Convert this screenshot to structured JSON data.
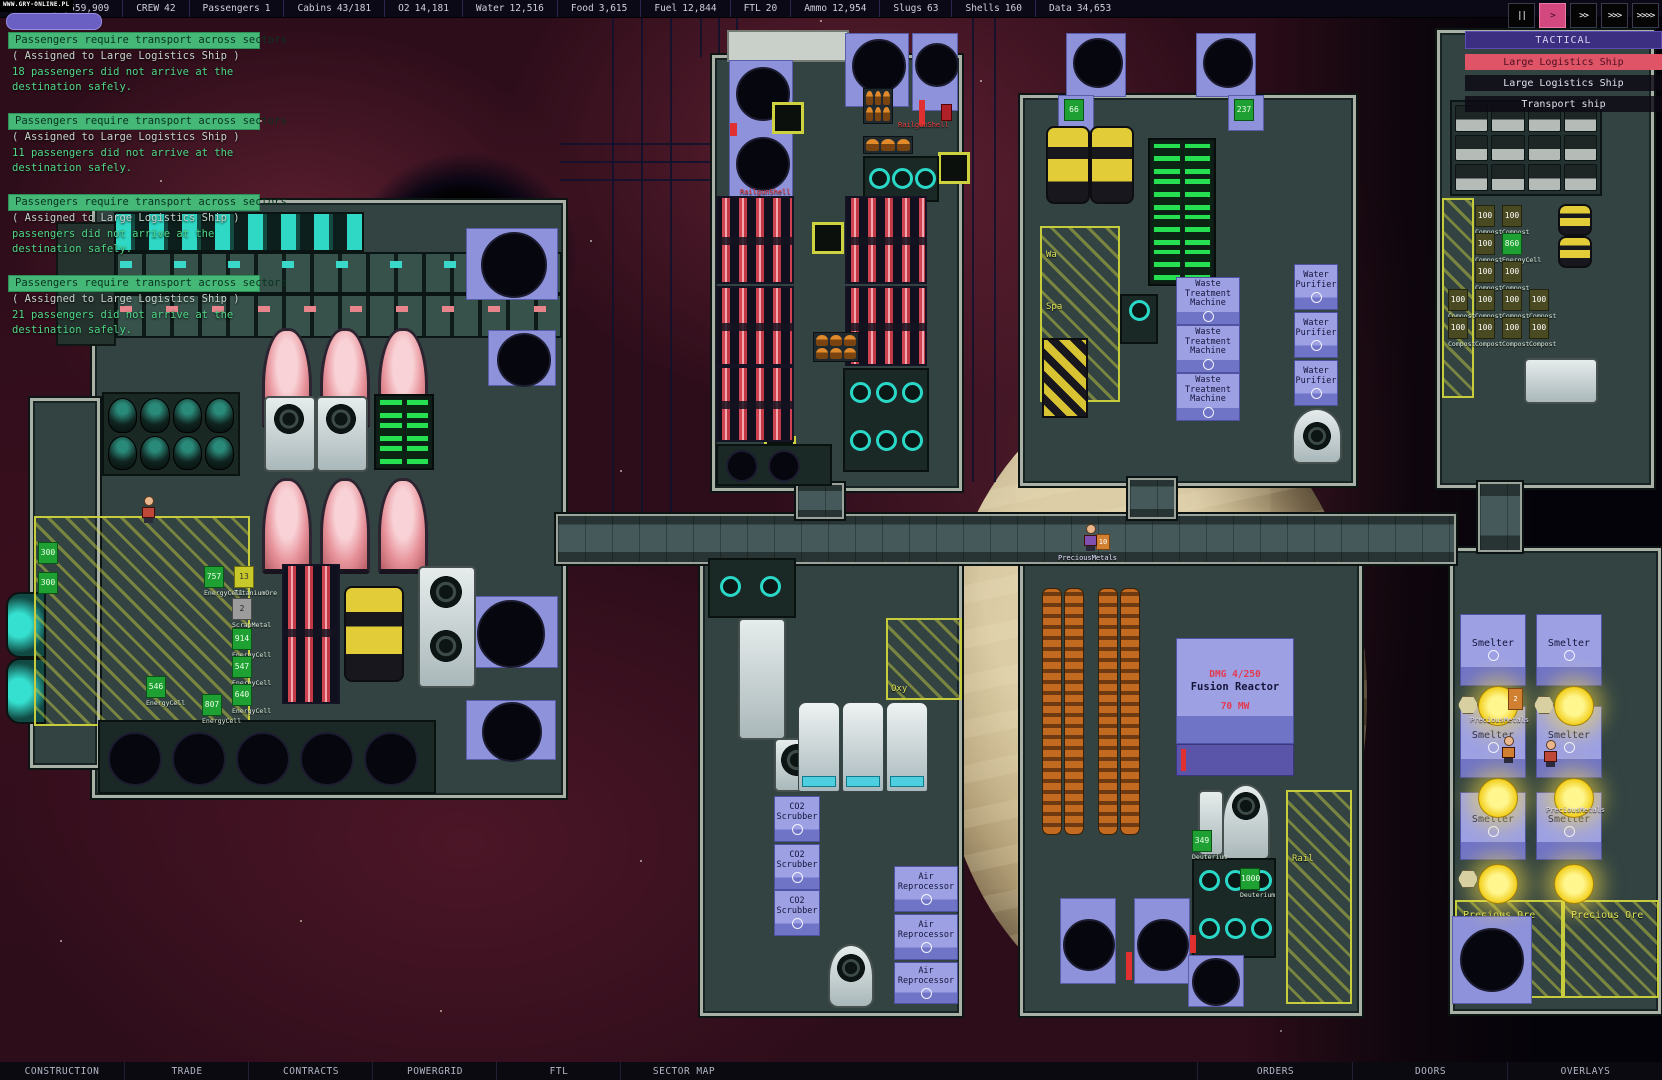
{
  "watermark": "WWW.GRY-ONLINE.PL",
  "topbar": {
    "money": "$8,559,909",
    "stats": [
      {
        "label": "CREW",
        "value": "42"
      },
      {
        "label": "Passengers",
        "value": "1"
      },
      {
        "label": "Cabins",
        "value": "43/181"
      },
      {
        "label": "O2",
        "value": "14,181"
      },
      {
        "label": "Water",
        "value": "12,516"
      },
      {
        "label": "Food",
        "value": "3,615"
      },
      {
        "label": "Fuel",
        "value": "12,844"
      },
      {
        "label": "FTL",
        "value": "20"
      },
      {
        "label": "Ammo",
        "value": "12,954"
      },
      {
        "label": "Slugs",
        "value": "63"
      },
      {
        "label": "Shells",
        "value": "160"
      },
      {
        "label": "Data",
        "value": "34,653"
      }
    ]
  },
  "speed_controls": {
    "pause": "||",
    "play": ">",
    "ff2": ">>",
    "ff3": ">>>",
    "ff4": ">>>>"
  },
  "notifications": [
    {
      "title": "Passengers require transport across sectors",
      "assigned": "( Assigned to Large Logistics Ship )",
      "line1": "18 passengers did not arrive at the",
      "line2": "destination safely."
    },
    {
      "title": "Passengers require transport across sectors",
      "assigned": "( Assigned to Large Logistics Ship )",
      "line1": "11 passengers did not arrive at the",
      "line2": "destination safely."
    },
    {
      "title": "Passengers require transport across sectors",
      "assigned": "( Assigned to Large Logistics Ship )",
      "line1": "passengers did not arrive at the",
      "line2": "destination safely."
    },
    {
      "title": "Passengers require transport across sectors",
      "assigned": "( Assigned to Large Logistics Ship )",
      "line1": "21 passengers did not arrive at the",
      "line2": "destination safely."
    }
  ],
  "tactical": {
    "title": "TACTICAL",
    "ships": [
      {
        "name": "Large Logistics Ship",
        "selected": true
      },
      {
        "name": "Large Logistics Ship",
        "selected": false
      },
      {
        "name": "Transport ship",
        "selected": false
      }
    ]
  },
  "bottombar": {
    "left": [
      "CONSTRUCTION",
      "TRADE",
      "CONTRACTS",
      "POWERGRID",
      "FTL",
      "SECTOR MAP"
    ],
    "right": [
      "ORDERS",
      "DOORS",
      "OVERLAYS"
    ]
  },
  "machines": {
    "waste": "Waste Treatment Machine",
    "water": "Water Purifier",
    "air": "Air Reprocessor",
    "scrubber": "CO2 Scrubber",
    "smelter": "Smelter",
    "fusion_dmg": "DMG 4/250",
    "fusion_name": "Fusion Reactor",
    "fusion_power": "70 MW"
  },
  "zones": {
    "wa": "Wa",
    "spa": "Spa",
    "oxy": "Oxy",
    "rail": "Rail",
    "precious_ore": "Precious Ore"
  },
  "items": {
    "railgun_shell": "RailgunShell",
    "precious_metals": "PreciousMetals",
    "compost": {
      "qty": "100",
      "name": "Compost"
    },
    "stacks": [
      {
        "qty": "757",
        "name": "EnergyCell"
      },
      {
        "qty": "13",
        "name": "TitaniumOre"
      },
      {
        "qty": "2",
        "name": "ScrapMetal"
      },
      {
        "qty": "914",
        "name": "EnergyCell"
      },
      {
        "qty": "547",
        "name": "EnergyCell"
      },
      {
        "qty": "640",
        "name": "EnergyCell"
      },
      {
        "qty": "807",
        "name": "EnergyCell"
      },
      {
        "qty": "546",
        "name": "EnergyCell"
      },
      {
        "qty": "300",
        "name": ""
      },
      {
        "qty": "300",
        "name": ""
      },
      {
        "qty": "349",
        "name": "Deuterium"
      },
      {
        "qty": "1000",
        "name": "Deuterium"
      },
      {
        "qty": "860",
        "name": "EnergyCell"
      },
      {
        "qty": "66",
        "name": ""
      },
      {
        "qty": "237",
        "name": ""
      },
      {
        "qty": "2",
        "name": ""
      },
      {
        "qty": "10",
        "name": ""
      }
    ]
  },
  "colors": {
    "accent_pink": "#d2487f",
    "notify_green": "#45b878",
    "tactical_purple": "#3c2e80",
    "machine_purple": "#9da1e4"
  }
}
